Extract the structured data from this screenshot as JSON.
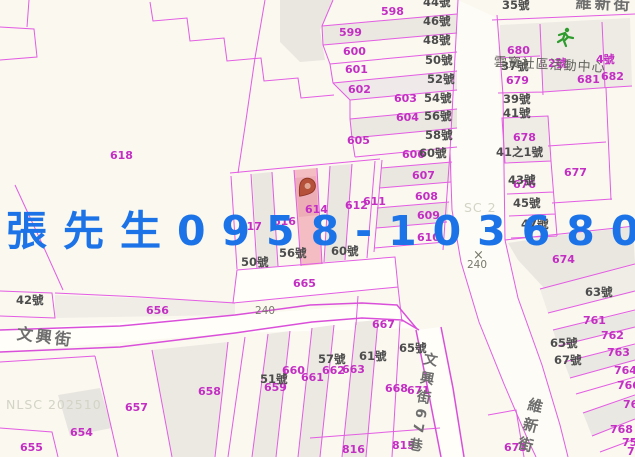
{
  "overlay": {
    "contact_text": "張先生0958-103680",
    "contact_color": "#1c73e8"
  },
  "map": {
    "colors": {
      "background": "#faf8ef",
      "boundary_line": "#e35ce3",
      "parcel_number": "#c32ec3",
      "house_number": "#4c4c4c",
      "street_name": "#6e6e6e",
      "highlight_fill": "#f3bdc3",
      "marker": "#b5503a",
      "activity_icon_green": "#2d9b2d",
      "watermark": "#d3d3c6"
    },
    "labels": [
      {
        "t": "598",
        "x": 381,
        "y": 6,
        "c": "p"
      },
      {
        "t": "599",
        "x": 339,
        "y": 27,
        "c": "p"
      },
      {
        "t": "600",
        "x": 343,
        "y": 46,
        "c": "p"
      },
      {
        "t": "601",
        "x": 345,
        "y": 64,
        "c": "p"
      },
      {
        "t": "602",
        "x": 348,
        "y": 84,
        "c": "p"
      },
      {
        "t": "603",
        "x": 394,
        "y": 93,
        "c": "p"
      },
      {
        "t": "604",
        "x": 396,
        "y": 112,
        "c": "p"
      },
      {
        "t": "605",
        "x": 347,
        "y": 135,
        "c": "p"
      },
      {
        "t": "606",
        "x": 402,
        "y": 149,
        "c": "p"
      },
      {
        "t": "607",
        "x": 412,
        "y": 170,
        "c": "p"
      },
      {
        "t": "608",
        "x": 415,
        "y": 191,
        "c": "p"
      },
      {
        "t": "609",
        "x": 417,
        "y": 210,
        "c": "p"
      },
      {
        "t": "610",
        "x": 417,
        "y": 232,
        "c": "p"
      },
      {
        "t": "611",
        "x": 363,
        "y": 196,
        "c": "p"
      },
      {
        "t": "612",
        "x": 345,
        "y": 200,
        "c": "p"
      },
      {
        "t": "614",
        "x": 305,
        "y": 204,
        "c": "p"
      },
      {
        "t": "616",
        "x": 273,
        "y": 216,
        "c": "p"
      },
      {
        "t": "617",
        "x": 239,
        "y": 221,
        "c": "p"
      },
      {
        "t": "618",
        "x": 110,
        "y": 150,
        "c": "p"
      },
      {
        "t": "654",
        "x": 70,
        "y": 427,
        "c": "p"
      },
      {
        "t": "655",
        "x": 20,
        "y": 442,
        "c": "p"
      },
      {
        "t": "656",
        "x": 146,
        "y": 305,
        "c": "p"
      },
      {
        "t": "657",
        "x": 125,
        "y": 402,
        "c": "p"
      },
      {
        "t": "658",
        "x": 198,
        "y": 386,
        "c": "p"
      },
      {
        "t": "659",
        "x": 264,
        "y": 382,
        "c": "p"
      },
      {
        "t": "660",
        "x": 282,
        "y": 365,
        "c": "p"
      },
      {
        "t": "661",
        "x": 301,
        "y": 372,
        "c": "p"
      },
      {
        "t": "662",
        "x": 322,
        "y": 365,
        "c": "p"
      },
      {
        "t": "663",
        "x": 342,
        "y": 364,
        "c": "p"
      },
      {
        "t": "665",
        "x": 293,
        "y": 278,
        "c": "p"
      },
      {
        "t": "667",
        "x": 372,
        "y": 319,
        "c": "p"
      },
      {
        "t": "668",
        "x": 385,
        "y": 383,
        "c": "p"
      },
      {
        "t": "671",
        "x": 407,
        "y": 385,
        "c": "p"
      },
      {
        "t": "673",
        "x": 504,
        "y": 442,
        "c": "p"
      },
      {
        "t": "674",
        "x": 552,
        "y": 254,
        "c": "p"
      },
      {
        "t": "676",
        "x": 513,
        "y": 179,
        "c": "p"
      },
      {
        "t": "677",
        "x": 564,
        "y": 167,
        "c": "p"
      },
      {
        "t": "678",
        "x": 513,
        "y": 132,
        "c": "p"
      },
      {
        "t": "679",
        "x": 506,
        "y": 75,
        "c": "p"
      },
      {
        "t": "680",
        "x": 507,
        "y": 45,
        "c": "p"
      },
      {
        "t": "681",
        "x": 577,
        "y": 74,
        "c": "p"
      },
      {
        "t": "682",
        "x": 601,
        "y": 71,
        "c": "p"
      },
      {
        "t": "761",
        "x": 583,
        "y": 315,
        "c": "p"
      },
      {
        "t": "762",
        "x": 601,
        "y": 330,
        "c": "p"
      },
      {
        "t": "763",
        "x": 607,
        "y": 347,
        "c": "p"
      },
      {
        "t": "764",
        "x": 614,
        "y": 365,
        "c": "p"
      },
      {
        "t": "766",
        "x": 617,
        "y": 380,
        "c": "p"
      },
      {
        "t": "767",
        "x": 623,
        "y": 399,
        "c": "p"
      },
      {
        "t": "768",
        "x": 610,
        "y": 424,
        "c": "p"
      },
      {
        "t": "75",
        "x": 622,
        "y": 437,
        "c": "p"
      },
      {
        "t": "76",
        "x": 627,
        "y": 446,
        "c": "p"
      },
      {
        "t": "815",
        "x": 392,
        "y": 440,
        "c": "p"
      },
      {
        "t": "816",
        "x": 342,
        "y": 444,
        "c": "p"
      },
      {
        "t": "2號",
        "x": 548,
        "y": 58,
        "c": "p"
      },
      {
        "t": "4號",
        "x": 596,
        "y": 54,
        "c": "p"
      },
      {
        "t": "44號",
        "x": 423,
        "y": -3,
        "c": "h"
      },
      {
        "t": "46號",
        "x": 423,
        "y": 16,
        "c": "h"
      },
      {
        "t": "48號",
        "x": 423,
        "y": 35,
        "c": "h"
      },
      {
        "t": "50號",
        "x": 425,
        "y": 55,
        "c": "h"
      },
      {
        "t": "52號",
        "x": 427,
        "y": 74,
        "c": "h"
      },
      {
        "t": "54號",
        "x": 424,
        "y": 93,
        "c": "h"
      },
      {
        "t": "56號",
        "x": 424,
        "y": 111,
        "c": "h"
      },
      {
        "t": "58號",
        "x": 425,
        "y": 130,
        "c": "h"
      },
      {
        "t": "60號",
        "x": 419,
        "y": 148,
        "c": "h"
      },
      {
        "t": "35號",
        "x": 502,
        "y": 0,
        "c": "h"
      },
      {
        "t": "37號",
        "x": 501,
        "y": 61,
        "c": "h"
      },
      {
        "t": "39號",
        "x": 503,
        "y": 94,
        "c": "h"
      },
      {
        "t": "41號",
        "x": 503,
        "y": 108,
        "c": "h"
      },
      {
        "t": "41之1號",
        "x": 496,
        "y": 147,
        "c": "h"
      },
      {
        "t": "43號",
        "x": 508,
        "y": 175,
        "c": "h"
      },
      {
        "t": "45號",
        "x": 513,
        "y": 198,
        "c": "h"
      },
      {
        "t": "47號",
        "x": 521,
        "y": 219,
        "c": "h"
      },
      {
        "t": "42號",
        "x": 16,
        "y": 295,
        "c": "h"
      },
      {
        "t": "50號",
        "x": 241,
        "y": 257,
        "c": "h"
      },
      {
        "t": "56號",
        "x": 279,
        "y": 248,
        "c": "h"
      },
      {
        "t": "60號",
        "x": 331,
        "y": 246,
        "c": "h"
      },
      {
        "t": "63號",
        "x": 585,
        "y": 287,
        "c": "h"
      },
      {
        "t": "65號",
        "x": 550,
        "y": 338,
        "c": "h"
      },
      {
        "t": "67號",
        "x": 554,
        "y": 355,
        "c": "h"
      },
      {
        "t": "65號",
        "x": 399,
        "y": 343,
        "c": "h"
      },
      {
        "t": "61號",
        "x": 359,
        "y": 351,
        "c": "h"
      },
      {
        "t": "57號",
        "x": 318,
        "y": 354,
        "c": "h"
      },
      {
        "t": "51號",
        "x": 260,
        "y": 374,
        "c": "h"
      },
      {
        "t": "×",
        "x": 473,
        "y": 249,
        "c": "c",
        "fs": 13
      },
      {
        "t": "240",
        "x": 467,
        "y": 260,
        "c": "c"
      },
      {
        "t": "240",
        "x": 255,
        "y": 306,
        "c": "c"
      },
      {
        "t": "維新街",
        "x": 576,
        "y": -5,
        "c": "s",
        "r": 2
      },
      {
        "t": "文興街",
        "x": 18,
        "y": 326,
        "c": "s",
        "r": 7
      },
      {
        "t": "文興街67巷",
        "x": 424,
        "y": 351,
        "c": "s v",
        "r": 10,
        "fs": 14
      },
      {
        "t": "維新街",
        "x": 529,
        "y": 396,
        "c": "s v",
        "r": 14,
        "fs": 15
      },
      {
        "t": "雲寶社區活動中心",
        "x": 494,
        "y": 56,
        "c": "b",
        "r": 3
      },
      {
        "t": "NLSC 202510",
        "x": 6,
        "y": 399,
        "c": "w"
      },
      {
        "t": "SC 2",
        "x": 464,
        "y": 202,
        "c": "w"
      }
    ]
  }
}
